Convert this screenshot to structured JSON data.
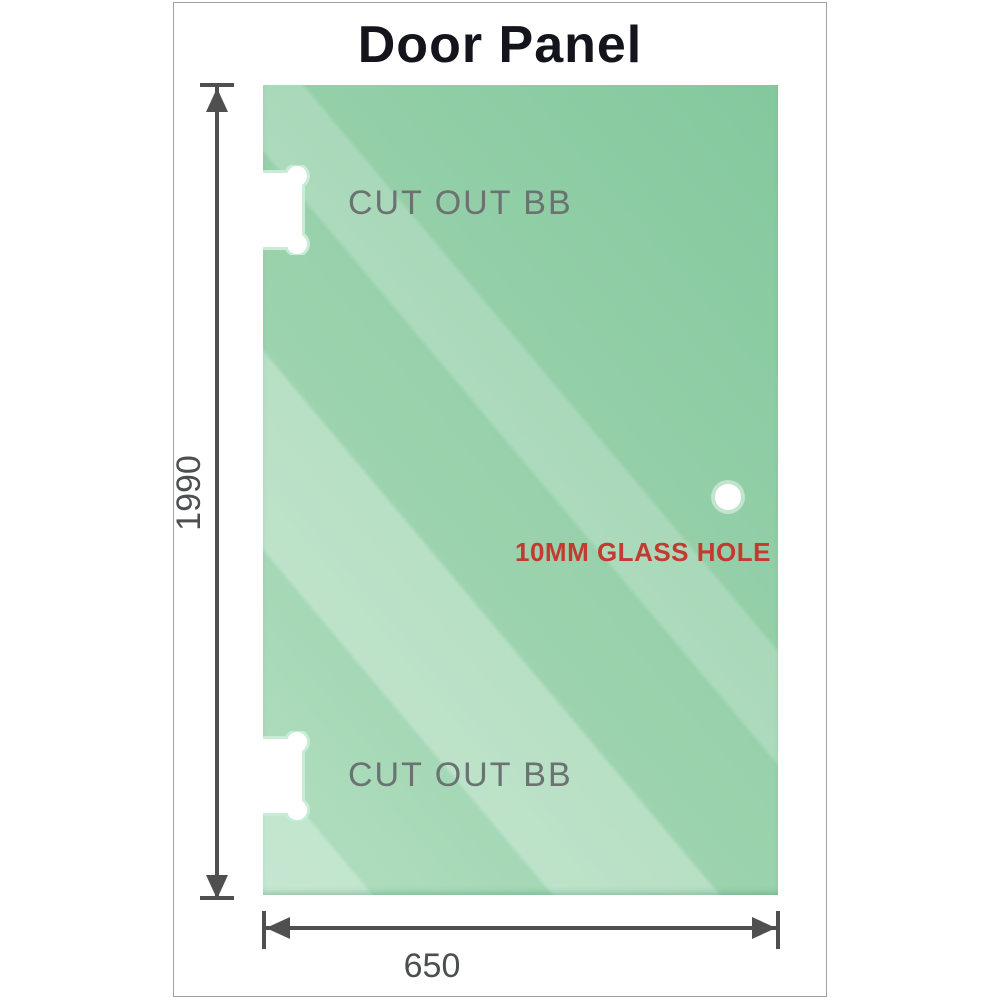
{
  "diagram": {
    "title": "Door Panel",
    "panel": {
      "cutouts": [
        {
          "label": "CUT OUT BB"
        },
        {
          "label": "CUT OUT BB"
        }
      ],
      "hole": {
        "label": "10MM GLASS HOLE"
      }
    },
    "dimensions": {
      "height": "1990",
      "width": "650"
    },
    "colors": {
      "glass_dark": "#84c89e",
      "glass_mid": "#9cd3ae",
      "glass_light": "#b2dfc1",
      "cutout_halo": "#c9ecd6",
      "dimension_lines": "#4f4f4f",
      "dimension_text": "#4b4f4f",
      "cutout_text": "#6b7272",
      "hole_text": "#c23a30",
      "title_text": "#14141c",
      "frame_border": "#a0a0a0"
    }
  }
}
